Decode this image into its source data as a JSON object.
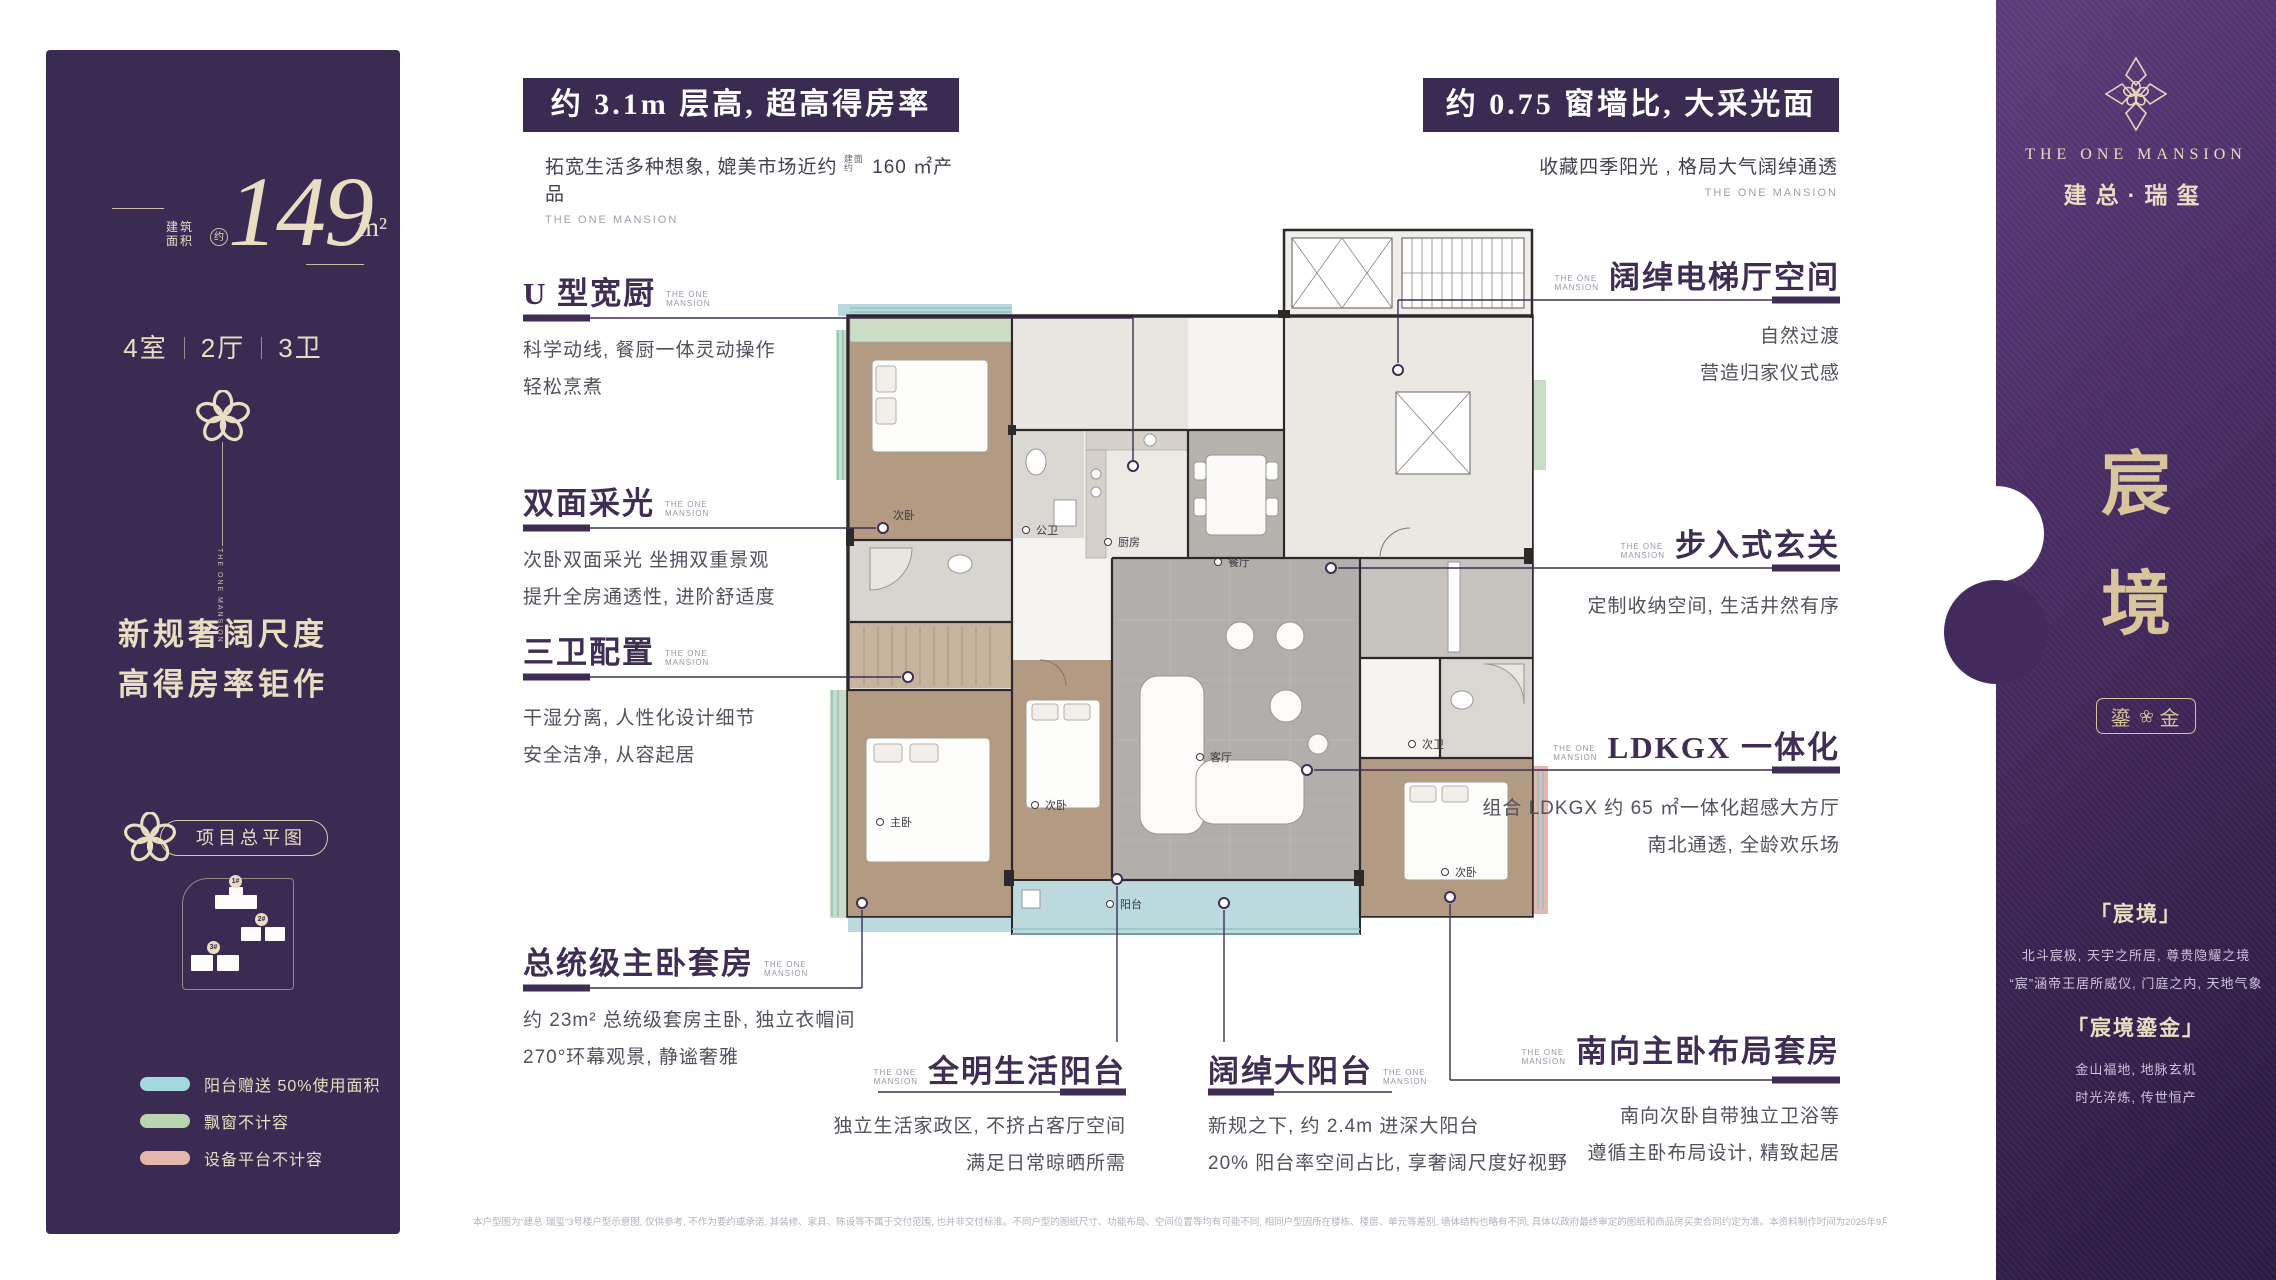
{
  "brand_small": {
    "l1": "THE ONE",
    "l2": "MANSION"
  },
  "left_panel": {
    "area_label_1": "建筑",
    "area_label_2": "面积",
    "area_circle": "约",
    "area_value": "149",
    "area_unit": "m²",
    "spec": [
      "4室",
      "2厅",
      "3卫"
    ],
    "brand_vertical": "THE ONE MANSION",
    "headline_line1": "新规奢阔尺度",
    "headline_line2": "高得房率钜作",
    "siteplan_badge": "项目总平图",
    "site_buildings": [
      "1#",
      "2#",
      "3#"
    ],
    "legend": [
      {
        "color": "#a3d8dc",
        "label": "阳台赠送 50%使用面积"
      },
      {
        "color": "#b9d4ae",
        "label": "飘窗不计容"
      },
      {
        "color": "#e3b7ad",
        "label": "设备平台不计容"
      }
    ]
  },
  "banners": {
    "left": {
      "title": "约 3.1m 层高, 超高得房率",
      "subtitle_pre": "拓宽生活多种想象, 媲美市场近约",
      "subtitle_tiny": "建面约",
      "subtitle_post": "160 ㎡产品",
      "brand": "THE ONE MANSION"
    },
    "right": {
      "title": "约 0.75 窗墙比, 大采光面",
      "subtitle": "收藏四季阳光 , 格局大气阔绰通透",
      "brand": "THE ONE MANSION"
    }
  },
  "callouts": {
    "kitchen": {
      "title": "U 型宽厨",
      "desc1": "科学动线, 餐厨一体灵动操作",
      "desc2": "轻松烹煮"
    },
    "dual_light": {
      "title": "双面采光",
      "desc1": "次卧双面采光 坐拥双重景观",
      "desc2": "提升全房通透性, 进阶舒适度"
    },
    "three_baths": {
      "title": "三卫配置",
      "desc1": "干湿分离, 人性化设计细节",
      "desc2": "安全洁净, 从容起居"
    },
    "master_suite": {
      "title": "总统级主卧套房",
      "desc1": "约 23m² 总统级套房主卧, 独立衣帽间",
      "desc2": "270°环幕观景, 静谧奢雅"
    },
    "elevator_hall": {
      "title": "阔绰电梯厅空间",
      "desc1": "自然过渡",
      "desc2": "营造归家仪式感"
    },
    "foyer": {
      "title": "步入式玄关",
      "desc1": "定制收纳空间, 生活井然有序"
    },
    "ldkgx": {
      "title": "LDKGX 一体化",
      "desc1": "组合 LDKGX 约 65 ㎡一体化超感大方厅",
      "desc2": "南北通透, 全龄欢乐场"
    },
    "south_suite": {
      "title": "南向主卧布局套房",
      "desc1": "南向次卧自带独立卫浴等",
      "desc2": "遵循主卧布局设计, 精致起居"
    },
    "life_balcony": {
      "title": "全明生活阳台",
      "desc1": "独立生活家政区, 不挤占客厅空间",
      "desc2": "满足日常晾晒所需"
    },
    "big_balcony": {
      "title": "阔绰大阳台",
      "desc1": "新规之下, 约 2.4m 进深大阳台",
      "desc2": "20% 阳台率空间占比, 享奢阔尺度好视野"
    }
  },
  "floor_plan": {
    "rooms": {
      "bed_top": "次卧",
      "bath_public": "公卫",
      "kitchen": "厨房",
      "dining": "餐厅",
      "living": "客厅",
      "master": "主卧",
      "bed_mid": "次卧",
      "bath_second": "次卫",
      "bed_br": "次卧",
      "balcony": "阳台"
    }
  },
  "right_panel": {
    "brand_en": "THE ONE MANSION",
    "brand_cn": "建总·瑞玺",
    "vertical_char_1": "宸",
    "vertical_char_2": "境",
    "badge_left": "鎏",
    "badge_right": "金",
    "block1_title": "「宸境」",
    "block1_line1": "北斗宸极, 天宇之所居, 尊贵隐耀之境",
    "block1_line2": "“宸”涵帝王居所威仪, 门庭之内, 天地气象",
    "block2_title": "「宸境鎏金」",
    "block2_line1": "金山福地, 地脉玄机",
    "block2_line2": "时光淬炼, 传世恒产"
  },
  "disclaimer": "本户型图为“建总·瑞玺”3号楼户型示意图, 仅供参考, 不作为要约或承诺, 其装修、家具、陈设等不属于交付范围, 也并非交付标准。不同户型的图纸尺寸、功能布局、空间位置等均有可能不同, 相同户型因所在楼栋、楼层、单元等差别, 墙体结构也略有不同, 具体以政府最终审定的图纸和商品房买卖合同约定为准。本资料制作时间为2025年9月, 在不违反法律法规、合同约定的前提下, 本公司保留对本宣传资料修改的权利, 敬请留意最新资料。"
}
